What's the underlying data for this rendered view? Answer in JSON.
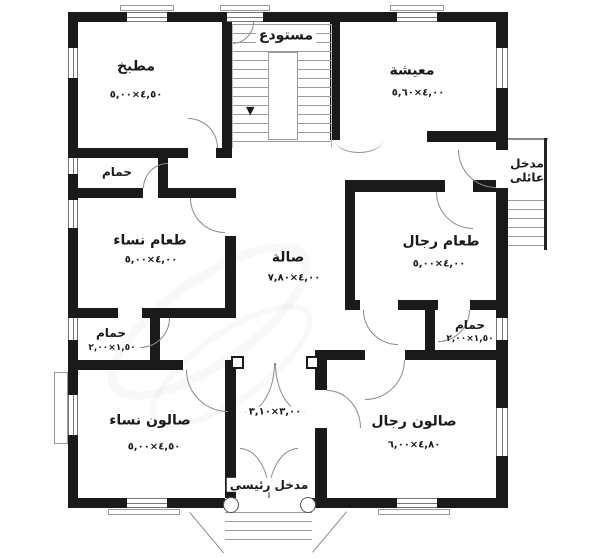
{
  "figure": {
    "type": "floor-plan",
    "background": "#ffffff",
    "wall_color": "#1a1a1a",
    "line_color": "#8a8a8a"
  },
  "rooms": {
    "kitchen": {
      "label": "مطبخ",
      "dims": "٤,٥٠×٥,٠٠"
    },
    "storage": {
      "label": "مستودع"
    },
    "living": {
      "label": "معيشة",
      "dims": "٤,٠٠×٥,٦٠"
    },
    "bath_top": {
      "label": "حمام"
    },
    "women_dining": {
      "label": "طعام نساء",
      "dims": "٤,٠٠×٥,٠٠"
    },
    "hall": {
      "label": "صالة",
      "dims": "٤,٠٠×٧,٨٠"
    },
    "men_dining": {
      "label": "طعام رجال",
      "dims": "٤,٠٠×٥,٠٠"
    },
    "family_entrance": {
      "line1": "مدخل",
      "line2": "عائلى"
    },
    "bath_left": {
      "label": "حمام",
      "dims": "١,٥٠×٢,٠٠"
    },
    "bath_right": {
      "label": "حمام",
      "dims": "١,٥٠×٢,٠٠"
    },
    "women_salon": {
      "label": "صالون نساء",
      "dims": "٤,٥٠×٥,٠٠"
    },
    "men_salon": {
      "label": "صالون رجال",
      "dims": "٤,٨٠×٦,٠٠"
    },
    "vestibule": {
      "dims": "٣,٠٠×٣,١٠"
    },
    "main_entrance": {
      "label": "مدخل رئيسى"
    }
  },
  "symbols": {
    "stair_down_arrow": "▼"
  }
}
